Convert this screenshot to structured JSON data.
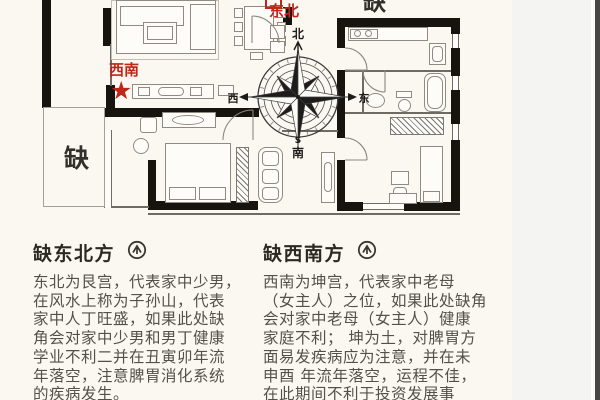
{
  "colors": {
    "accent_red": "#c0251a",
    "wall_black": "#17140f",
    "page_bg": "#fbf8f2",
    "margin_gray": "#f4f4f2"
  },
  "floorplan": {
    "missing_label_bottom_left": "缺",
    "missing_label_top_right": "缺",
    "southwest_label": "西南",
    "northeast_label": "东北",
    "star": "★",
    "compass": {
      "north": "北",
      "south": "南",
      "east": "东",
      "west": "西",
      "s_letter": "S"
    }
  },
  "sections": {
    "northeast": {
      "heading": "缺东北方",
      "body": [
        "东北为艮宫，代表家中少男，",
        "在风水上称为子孙山，代表",
        "家中人丁旺盛，如果此处缺",
        "角会对家中少男和男丁健康",
        "学业不利二并在丑寅卯年流",
        "年落空，注意脾胃消化系统",
        "的疾病发生。"
      ]
    },
    "southwest": {
      "heading": "缺西南方",
      "body": [
        "西南为坤宫，代表家中老母",
        "（女主人）之位，如果此处缺角",
        "会对家中老母（女主人）健康",
        "家庭不利； 坤为土，对脾胃方",
        "面易发疾病应为注意，并在未",
        "申酉 年流年落空，运程不佳，",
        "在此期间不利于投资发展事"
      ]
    }
  }
}
